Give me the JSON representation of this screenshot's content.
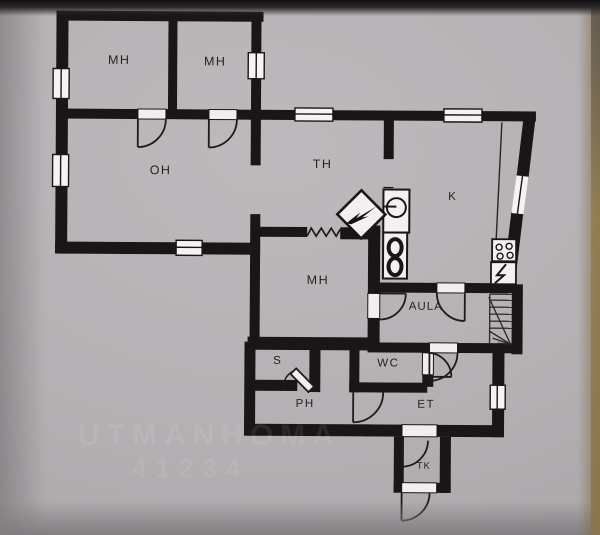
{
  "document": {
    "type": "floor-plan photo",
    "description": "hand-drafted single-storey house floor plan on grey paper"
  },
  "rooms": {
    "mh1": {
      "label": "MH"
    },
    "mh2": {
      "label": "MH"
    },
    "oh": {
      "label": "OH"
    },
    "th": {
      "label": "TH"
    },
    "k": {
      "label": "K"
    },
    "mh3": {
      "label": "MH"
    },
    "aula": {
      "label": "AULA"
    },
    "s": {
      "label": "S"
    },
    "wc": {
      "label": "WC"
    },
    "ph": {
      "label": "PH"
    },
    "et": {
      "label": "ET"
    },
    "tk": {
      "label": "TK"
    }
  },
  "fixtures": [
    "fireplace-icon",
    "radiator-zigzag-icon",
    "sink-icon",
    "stove-icon",
    "cooktop-icon",
    "electric-panel-icon",
    "staircase",
    "window-symbol",
    "door-arc"
  ],
  "watermark": {
    "line1": "UTMANHOMA",
    "line2": "41234"
  },
  "colors": {
    "paper": "#b4b0b3",
    "wall": "#1a1618",
    "label": "#262224",
    "photo_edge_brown": "#8a744b"
  }
}
